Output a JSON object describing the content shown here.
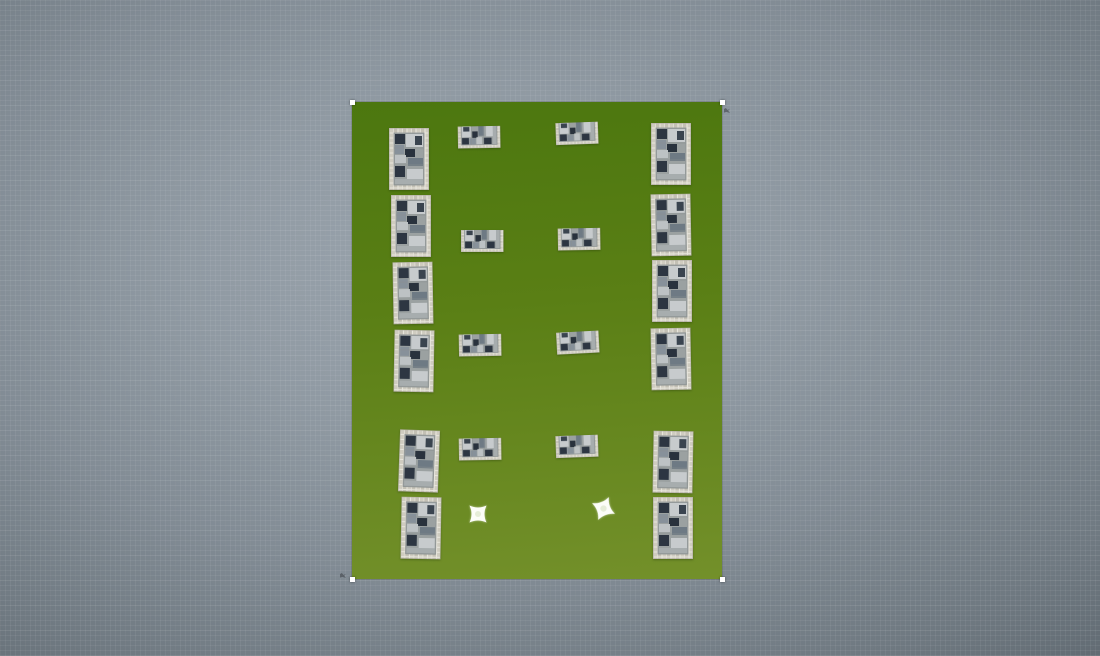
{
  "canvas": {
    "width": 1100,
    "height": 656,
    "background_center": "#9aa4ad",
    "background_edge": "#5d666e",
    "grid_line": "rgba(255,255,255,0.055)"
  },
  "field": {
    "x": 352,
    "y": 102,
    "width": 370,
    "height": 477,
    "grass_top": "#4c770f",
    "grass_mid": "#5a7f15",
    "grass_bottom": "#73902a",
    "selected": true,
    "handle_color": "#ffffff",
    "handles": [
      "top-left",
      "top-right",
      "bottom-left",
      "bottom-right"
    ]
  },
  "sprite_colors": {
    "wall_mortar": "#e8e6dd",
    "wall_stone_light": "#cfccc0",
    "wall_stone_dark": "#c3c0b4",
    "floor": "#9ba1a1",
    "block_dark": "#2d3642",
    "block_light": "#c7cbcd",
    "block_mid": "#6e7a84",
    "block_gray": "#87919a",
    "sparkle": "#fcfdf8",
    "sparkle_center": "#e6edd8"
  },
  "buildings": [
    {
      "id": "left-1",
      "orientation": "vertical",
      "x": 389,
      "y": 128,
      "rot": 0
    },
    {
      "id": "left-2",
      "orientation": "vertical",
      "x": 391,
      "y": 195,
      "rot": 0
    },
    {
      "id": "left-3",
      "orientation": "vertical",
      "x": 393,
      "y": 262,
      "rot": -1
    },
    {
      "id": "left-4",
      "orientation": "vertical",
      "x": 394,
      "y": 330,
      "rot": 1
    },
    {
      "id": "left-5",
      "orientation": "vertical",
      "x": 399,
      "y": 430,
      "rot": 2
    },
    {
      "id": "left-6",
      "orientation": "vertical",
      "x": 401,
      "y": 497,
      "rot": 1
    },
    {
      "id": "mid-left-1",
      "orientation": "horizontal",
      "x": 458,
      "y": 126,
      "rot": -1
    },
    {
      "id": "mid-left-2",
      "orientation": "horizontal",
      "x": 461,
      "y": 230,
      "rot": 0
    },
    {
      "id": "mid-left-3",
      "orientation": "horizontal",
      "x": 459,
      "y": 334,
      "rot": -1
    },
    {
      "id": "mid-left-4",
      "orientation": "horizontal",
      "x": 459,
      "y": 438,
      "rot": -1
    },
    {
      "id": "mid-right-1",
      "orientation": "horizontal",
      "x": 556,
      "y": 122,
      "rot": -2
    },
    {
      "id": "mid-right-2",
      "orientation": "horizontal",
      "x": 558,
      "y": 228,
      "rot": -1
    },
    {
      "id": "mid-right-3",
      "orientation": "horizontal",
      "x": 557,
      "y": 331,
      "rot": -3
    },
    {
      "id": "mid-right-4",
      "orientation": "horizontal",
      "x": 556,
      "y": 435,
      "rot": -2
    },
    {
      "id": "right-1",
      "orientation": "vertical",
      "x": 651,
      "y": 123,
      "rot": 0
    },
    {
      "id": "right-2",
      "orientation": "vertical",
      "x": 651,
      "y": 194,
      "rot": -1
    },
    {
      "id": "right-3",
      "orientation": "vertical",
      "x": 652,
      "y": 260,
      "rot": 0
    },
    {
      "id": "right-4",
      "orientation": "vertical",
      "x": 651,
      "y": 328,
      "rot": -1
    },
    {
      "id": "right-5",
      "orientation": "vertical",
      "x": 653,
      "y": 431,
      "rot": 1
    },
    {
      "id": "right-6",
      "orientation": "vertical",
      "x": 653,
      "y": 497,
      "rot": 0
    }
  ],
  "building_size": {
    "vertical": {
      "w": 40,
      "h": 62
    },
    "horizontal": {
      "w": 66,
      "h": 40
    }
  },
  "sparkles": [
    {
      "id": "sparkle-1",
      "x": 468,
      "y": 504,
      "size": 20,
      "rot": 0
    },
    {
      "id": "sparkle-2",
      "x": 593,
      "y": 498,
      "size": 21,
      "rot": -20
    }
  ],
  "smudges": [
    {
      "x": 724,
      "y": 108
    },
    {
      "x": 340,
      "y": 573
    }
  ]
}
